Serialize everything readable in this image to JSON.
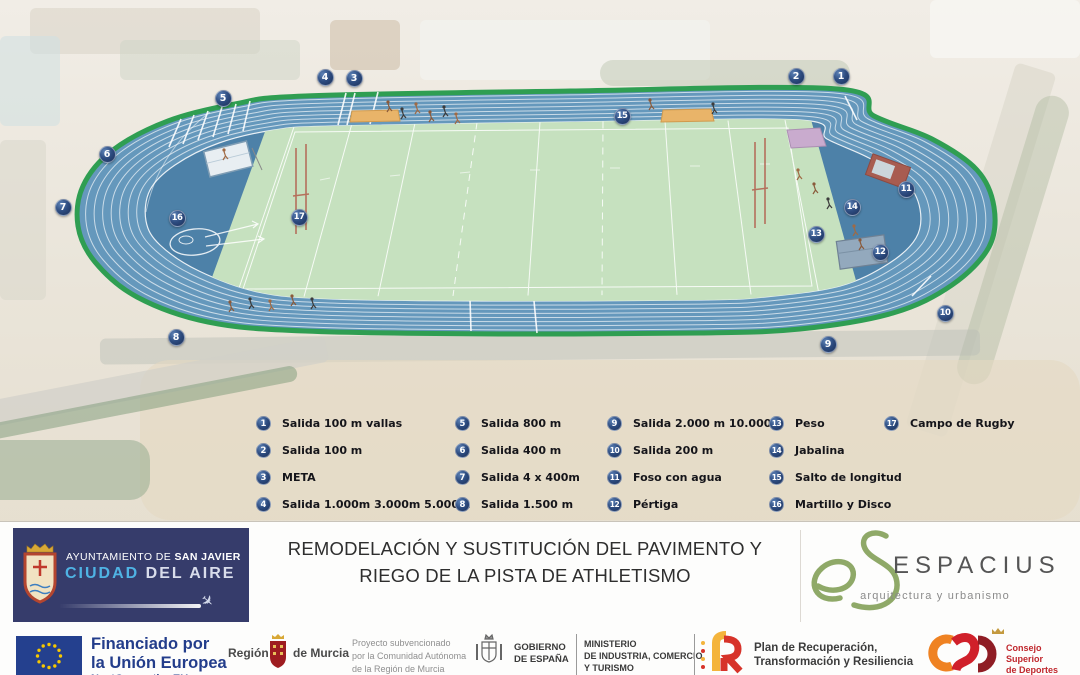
{
  "diagram": {
    "markers": [
      {
        "n": "1",
        "x": 841,
        "y": 76
      },
      {
        "n": "2",
        "x": 796,
        "y": 76
      },
      {
        "n": "3",
        "x": 354,
        "y": 78
      },
      {
        "n": "4",
        "x": 325,
        "y": 77
      },
      {
        "n": "5",
        "x": 223,
        "y": 98
      },
      {
        "n": "6",
        "x": 107,
        "y": 154
      },
      {
        "n": "7",
        "x": 63,
        "y": 207
      },
      {
        "n": "8",
        "x": 176,
        "y": 337
      },
      {
        "n": "9",
        "x": 828,
        "y": 344
      },
      {
        "n": "10",
        "x": 945,
        "y": 313
      },
      {
        "n": "11",
        "x": 906,
        "y": 189
      },
      {
        "n": "12",
        "x": 880,
        "y": 252
      },
      {
        "n": "13",
        "x": 816,
        "y": 234
      },
      {
        "n": "14",
        "x": 852,
        "y": 207
      },
      {
        "n": "15",
        "x": 622,
        "y": 116
      },
      {
        "n": "16",
        "x": 177,
        "y": 218
      },
      {
        "n": "17",
        "x": 299,
        "y": 217
      }
    ],
    "legend_columns": [
      [
        {
          "n": "1",
          "label": "Salida 100 m vallas"
        },
        {
          "n": "2",
          "label": "Salida 100 m"
        },
        {
          "n": "3",
          "label": "META"
        },
        {
          "n": "4",
          "label": "Salida 1.000m 3.000m 5.000m"
        }
      ],
      [
        {
          "n": "5",
          "label": "Salida 800 m"
        },
        {
          "n": "6",
          "label": "Salida 400 m"
        },
        {
          "n": "7",
          "label": "Salida 4 x 400m"
        },
        {
          "n": "8",
          "label": "Salida 1.500 m"
        }
      ],
      [
        {
          "n": "9",
          "label": "Salida 2.000 m 10.000m"
        },
        {
          "n": "10",
          "label": "Salida 200 m"
        },
        {
          "n": "11",
          "label": "Foso con agua"
        },
        {
          "n": "12",
          "label": "Pértiga"
        }
      ],
      [
        {
          "n": "13",
          "label": "Peso"
        },
        {
          "n": "14",
          "label": "Jabalina"
        },
        {
          "n": "15",
          "label": "Salto de longitud"
        },
        {
          "n": "16",
          "label": "Martillo y Disco"
        }
      ],
      [
        {
          "n": "17",
          "label": "Campo de Rugby"
        }
      ]
    ]
  },
  "footer": {
    "sanjavier_line1_prefix": "AYUNTAMIENTO DE ",
    "sanjavier_line1_bold": "SAN JAVIER",
    "sanjavier_line2_blue": "CIUDAD",
    "sanjavier_line2_rest": " DEL AIRE",
    "title_line1": "REMODELACIÓN Y SUSTITUCIÓN DEL PAVIMENTO Y",
    "title_line2": "RIEGO DE LA PISTA DE ATHLETISMO",
    "espacius_name": "ESPACIUS",
    "espacius_tagline": "arquitectura y urbanismo"
  },
  "funding_bar": {
    "eu_line1": "Financiado por",
    "eu_line2": "la Unión Europea",
    "eu_line3": "NextGenerationEU",
    "murcia_left": "Región",
    "murcia_right": "de Murcia",
    "subsidy_lines": [
      "Proyecto subvencionado",
      "por la Comunidad Autónoma",
      "de la Región de Murcia"
    ],
    "gobierno_lines": [
      "GOBIERNO",
      "DE ESPAÑA"
    ],
    "ministerio_lines": [
      "MINISTERIO",
      "DE INDUSTRIA, COMERCIO",
      "Y TURISMO"
    ],
    "prtr_lines": [
      "Plan de Recuperación,",
      "Transformación y Resiliencia"
    ],
    "csd_lines": [
      "Consejo",
      "Superior",
      "de Deportes"
    ]
  },
  "colors": {
    "track_lane_blue": "#6598bc",
    "track_infield_blue": "#4d81a8",
    "track_border_green": "#2f9e52",
    "rugby_green": "#c6e1bf",
    "marker_navy": "#24406e",
    "sanjavier_navy": "#363c6b",
    "eu_blue": "#24408e",
    "eu_star_yellow": "#f7c800",
    "espacius_green": "#8fa968",
    "prtr_red": "#d7332a",
    "prtr_yellow": "#f4b43c",
    "csd_orange": "#ef8222",
    "csd_red": "#d0202a"
  }
}
